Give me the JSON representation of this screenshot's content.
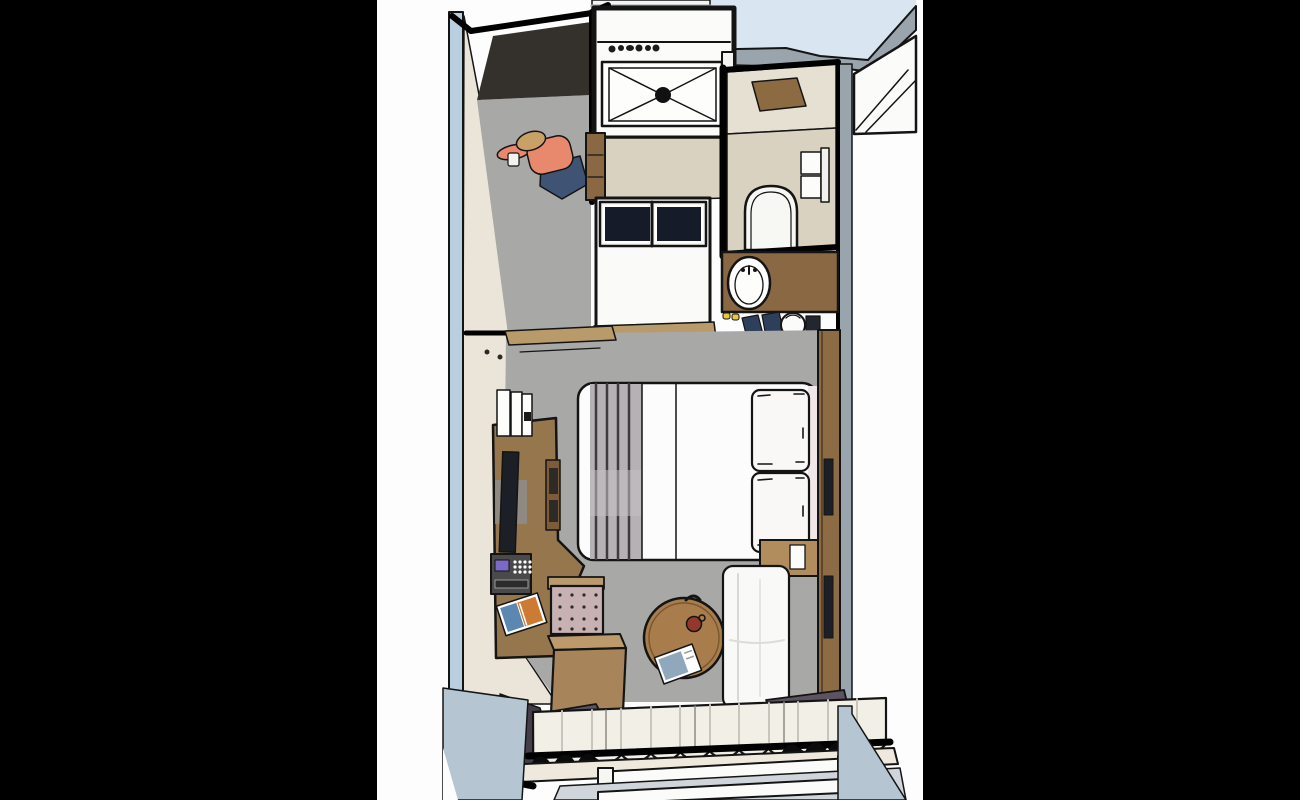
{
  "scene": {
    "label": "3D top-down floor plan rendering of a cruise-cabin style hotel room with entry wardrobe, shower room, toilet room, vanity, bedroom and balcony",
    "labels": {
      "letterbox_left": "black letterbox left",
      "letterbox_right": "black letterbox right",
      "adjacent_top": "adjacent space above cabin",
      "entry": "entry corridor and wardrobe",
      "person": "person standing in entry",
      "shower_room": "shower room",
      "bath_corridor": "bathroom vestibule",
      "luggage_unit": "luggage bench with glass shelves",
      "toilet_room": "toilet room",
      "vanity": "vanity counter with sink",
      "bedroom": "bedroom",
      "bed": "double bed with pillows",
      "desk": "desk console with TV and safe",
      "ottoman": "tufted ottoman",
      "cube_table": "wooden cube table",
      "coffee_table": "round coffee table",
      "armchair": "white armchair",
      "window": "window with curtains and balcony door",
      "balcony": "balcony floor"
    },
    "counts": {
      "sheer_curtain_ribs": 11,
      "ottoman_tuft_grid": "4x4",
      "toiletry_bottles": 6,
      "pillows": 2
    }
  },
  "palette": {
    "black_bar": "#000000",
    "page_bg": "#fdfdfe",
    "sky_blue": "#d9e6f1",
    "wall_blue": "#b9cfdf",
    "wall_gray": "#99a4ac",
    "wall_cream": "#eae5d8",
    "wall_cream_dark": "#ded8c8",
    "carpet": "#a8a8a6",
    "closet_dark": "#34302c",
    "bath_floor": "#d9d2c1",
    "toilet_floor_upper": "#e5e0d2",
    "mat_brown": "#8d6b42",
    "fixture_white": "#fafaf8",
    "glass_navy": "#161b29",
    "vanity_wood": "#8a6844",
    "desk_wood": "#96764c",
    "cube_wood": "#a8845a",
    "table_wood": "#a97d4b",
    "threshold_wood": "#b99a6a",
    "bed_white": "#fcfcfc",
    "runner_gray": "#b5b1b4",
    "runner_stripe": "#3f3a3c",
    "pillow_white": "#faf7f7",
    "headboard_wood": "#8d6b44",
    "nightstand_wood": "#b18c5c",
    "tv_dark": "#1d1f26",
    "safe_body": "#4a4a4a",
    "safe_screen": "#7b68c8",
    "magazine_blue": "#5b87b0",
    "magazine_orange": "#cd7a33",
    "ottoman_pink": "#c8b1b3",
    "chair_white": "#f9f9f7",
    "curtain_purple": "#5d5260",
    "curtain_purple_dark": "#453e49",
    "sheer": "#f2efe7",
    "sill_cream": "#eee9dc",
    "balcony_floor": "#b6c5d2",
    "door_floor": "#cfd5da",
    "person_shirt": "#e8896e",
    "person_pants": "#3f5474",
    "person_skin": "#d9b98c",
    "person_hair": "#c9a166",
    "cup_red": "#93382a",
    "shoe_navy": "#2e3f5c",
    "slipper_yellow": "#e8c93e",
    "line_ink": "#141414"
  }
}
